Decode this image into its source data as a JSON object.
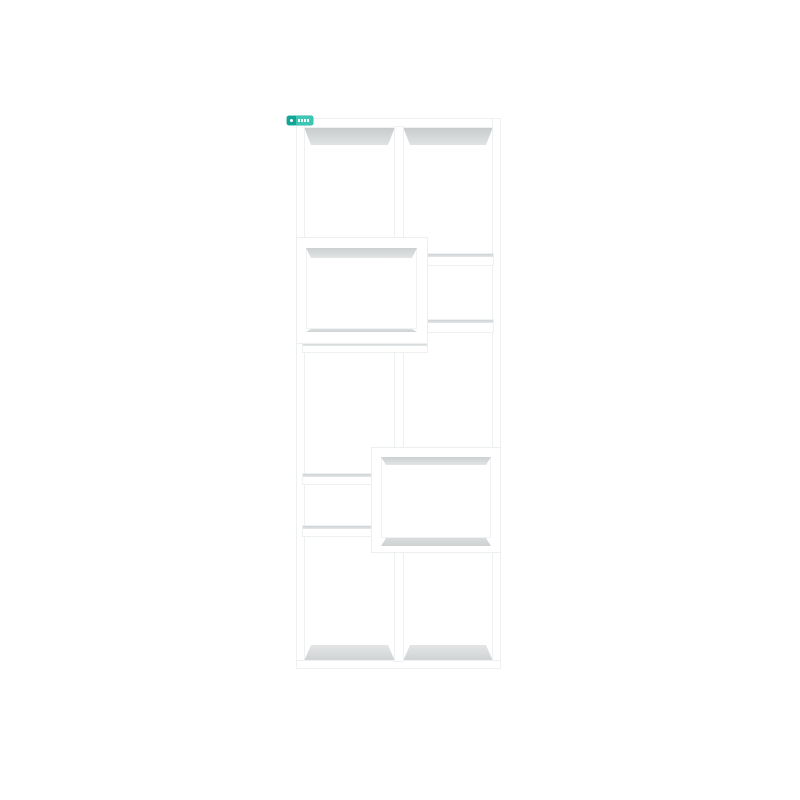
{
  "page": {
    "background_color": "#ffffff",
    "type": "product-render"
  },
  "product": {
    "name": "white-geometric-cube-bookshelf",
    "description": "Tall white open-back display bookcase with 10 asymmetric compartments, center dividers and two forward-protruding box shelves",
    "color": "#ffffff",
    "compartment_count": 10
  },
  "badge": {
    "fill_color": "#3cc6b4",
    "accent_color": "#14a495",
    "icon": "badge-dot-icon",
    "text_legible": false
  },
  "palette": {
    "shadow_gray_dark": "#c7cacb",
    "shadow_gray_light": "#e4e6e7",
    "floor_gray": "#d2d5d6",
    "edge_hairline": "#eef1f1"
  }
}
